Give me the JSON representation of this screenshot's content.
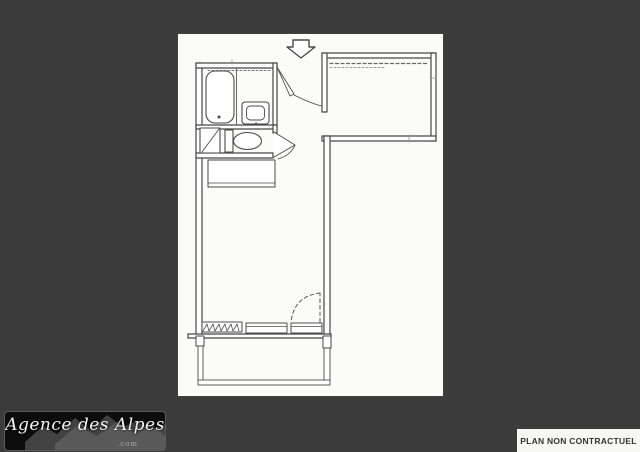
{
  "page": {
    "background_color": "#3b3b3b",
    "panel_background_color": "#fbfbfa",
    "ink_color": "#474747"
  },
  "watermark": {
    "brand": "Agence des Alpes",
    "suffix": ".com",
    "style": "white handwritten script on black box with gray mountain silhouette"
  },
  "disclaimer": {
    "label": "PLAN NON CONTRACTUEL"
  },
  "floor_plan": {
    "type": "studio-apartment-floor-plan",
    "symbols": [
      "entrance-arrow",
      "entrance-door-swing",
      "bathtub",
      "washbasin",
      "toilet",
      "utility-closet",
      "kitchenette-counter",
      "radiator",
      "window",
      "balcony-door-swing-dashed",
      "balcony-railing",
      "shelf-dashed-lines"
    ]
  }
}
